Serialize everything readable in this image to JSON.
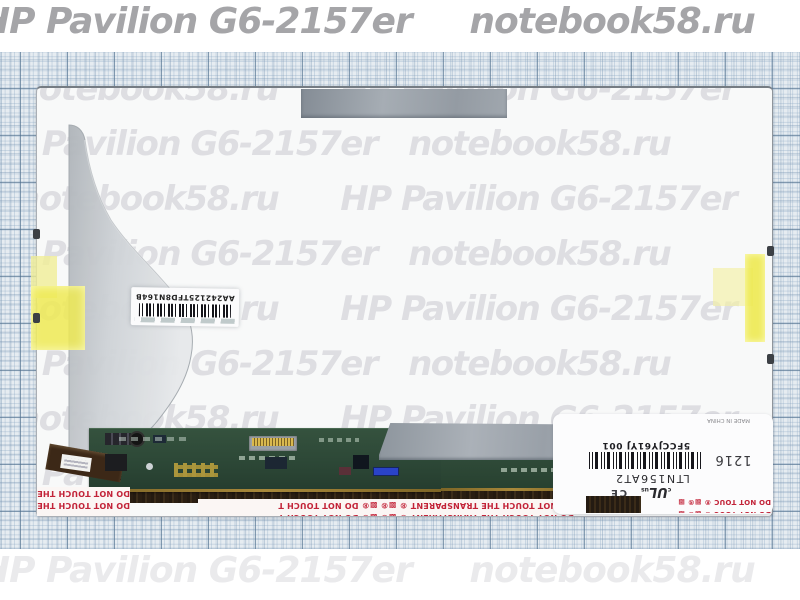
{
  "watermark": {
    "phrases": {
      "a": "HP Pavilion G6-2157er   notebook58.ru",
      "b": "notebook58.ru      HP Pavilion G6-2157er",
      "band": "HP Pavilion G6-2157er     notebook58.ru"
    },
    "rows": [
      {
        "container": "band-top",
        "left": -20,
        "top": 4,
        "phrase": "band",
        "cls": "wm-36 wm-dark"
      },
      {
        "container": "panel",
        "left": -21,
        "top": -16,
        "phrase": "b",
        "cls": "wm-inner"
      },
      {
        "container": "panel",
        "left": -56,
        "top": 39,
        "phrase": "a",
        "cls": "wm-inner"
      },
      {
        "container": "panel",
        "left": -21,
        "top": 94,
        "phrase": "b",
        "cls": "wm-inner"
      },
      {
        "container": "panel",
        "left": -56,
        "top": 149,
        "phrase": "a",
        "cls": "wm-inner"
      },
      {
        "container": "panel",
        "left": -21,
        "top": 204,
        "phrase": "b",
        "cls": "wm-inner"
      },
      {
        "container": "panel",
        "left": -56,
        "top": 259,
        "phrase": "a",
        "cls": "wm-inner"
      },
      {
        "container": "panel",
        "left": -21,
        "top": 314,
        "phrase": "b",
        "cls": "wm-inner"
      },
      {
        "container": "panel",
        "left": -56,
        "top": 369,
        "phrase": "a",
        "cls": "wm-inner"
      },
      {
        "container": "band-bottom",
        "left": -20,
        "top": 4,
        "phrase": "band",
        "cls": "wm-36 wm-light"
      }
    ]
  },
  "panel": {
    "barcode_label": {
      "code": "AA242125TFD8N164B"
    },
    "info_label": {
      "serial": "5FCCJY61YJ 001",
      "model": "LTN156AT2",
      "date_code": "1216",
      "made_in": "MADE IN CHINA",
      "cert_ul_c": "c",
      "cert_ul": "UL",
      "cert_ul_us": "us",
      "cert_ce": "CE",
      "warning_line": "DO NOT TOUC ®  ▩® ▩"
    },
    "warning_strips": {
      "left_line": "DO NOT TOUCH THE ®",
      "center_line": "DO NOT TOUCH THE TRANSPARENT ®   ▩® ▩®   DO NOT TOUCH T"
    }
  }
}
